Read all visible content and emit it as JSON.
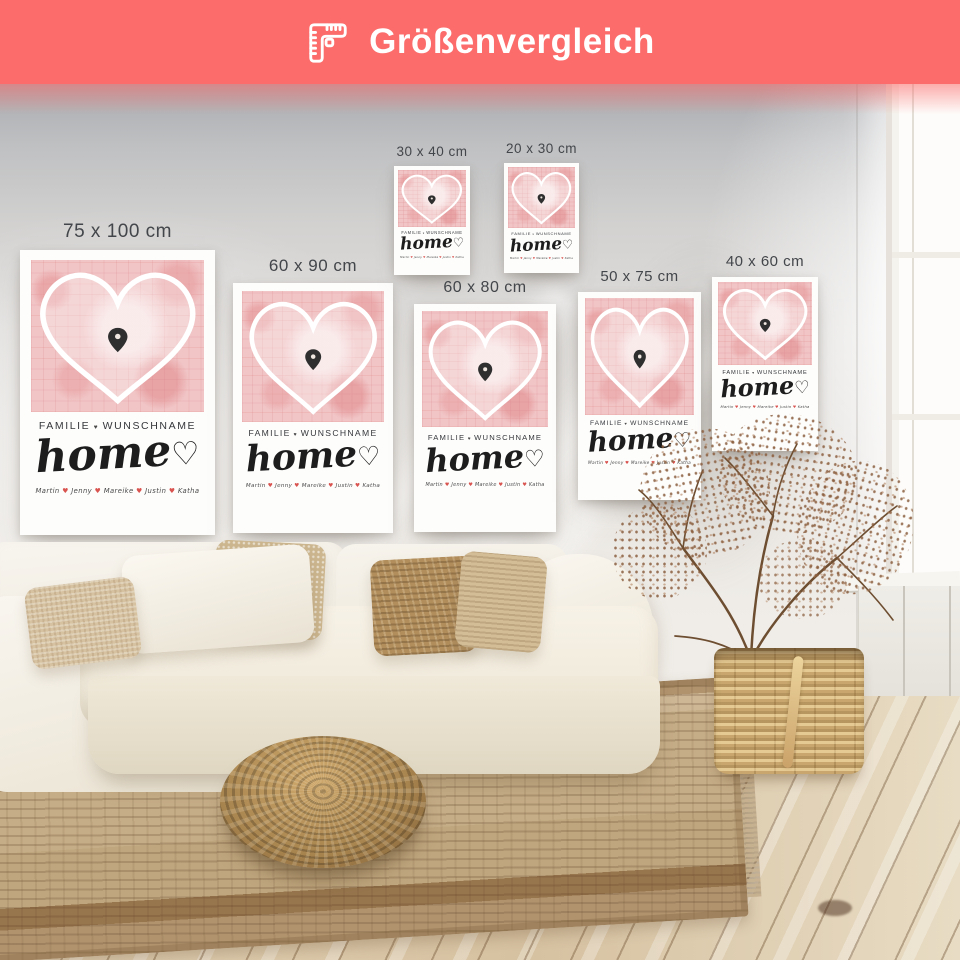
{
  "banner": {
    "title": "Größenvergleich",
    "icon": "folding-ruler-icon",
    "background_color": "#fb6c6b",
    "text_color": "#ffffff"
  },
  "posters": [
    {
      "size_label": "75 x 100 cm"
    },
    {
      "size_label": "60 x 90 cm"
    },
    {
      "size_label": "30 x 40 cm"
    },
    {
      "size_label": "20 x 30 cm"
    },
    {
      "size_label": "60 x 80 cm"
    },
    {
      "size_label": "50 x 75 cm"
    },
    {
      "size_label": "40 x 60 cm"
    }
  ],
  "poster_content": {
    "title_left": "FAMILIE",
    "title_separator": "♥",
    "title_right": "WUNSCHNAME",
    "script_word": "home",
    "script_heart": "♡",
    "names": [
      "Martin",
      "Jenny",
      "Mareike",
      "Justin",
      "Katha"
    ],
    "names_separator": "♥",
    "colors": {
      "map_pink": "#f2c6c7",
      "heart_outline": "#ffffff",
      "pin": "#2f2f2f",
      "names_heart_red": "#d9534f",
      "text_dark": "#35373a"
    }
  }
}
